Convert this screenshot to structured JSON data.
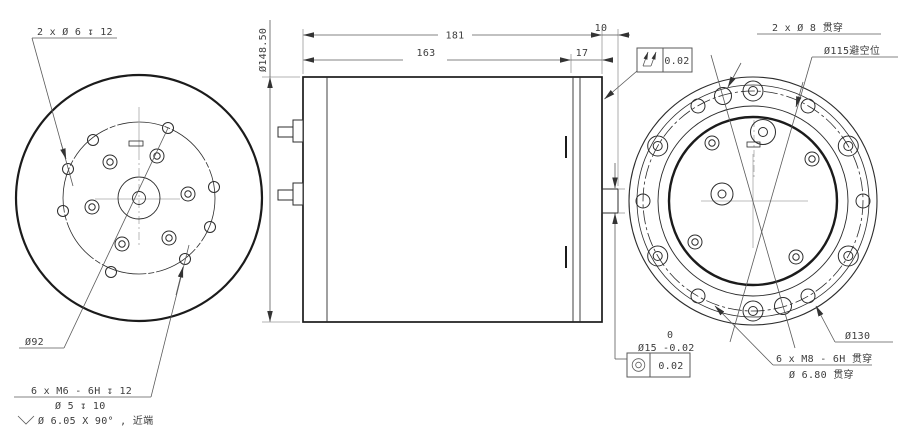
{
  "drawing": {
    "left_view": {
      "label_holes": "2 x Ø 6 ↧ 12",
      "label_bolt_circle": "Ø92",
      "label_thread1": "6 x M6 - 6H ↧ 12",
      "label_thread2": "Ø 5 ↧ 10",
      "label_thread3": "Ø 6.05 X 90° , 近端"
    },
    "front_view": {
      "dim_total": "181",
      "dim_body": "163",
      "dim_flange": "17",
      "dim_boss_len": "10",
      "dim_diameter": "Ø148.50",
      "runout_value": "0.02",
      "shaft_dia": "Ø15",
      "shaft_tol_upper": "0",
      "shaft_tol_lower": "-0.02",
      "concentricity_symbol": "◎",
      "concentricity_value": "0.02"
    },
    "right_view": {
      "label_holes": "2 x Ø 8 贯穿",
      "label_clearance": "Ø115避空位",
      "label_bolt_circle": "Ø130",
      "label_thread1": "6 x M8 - 6H 贯穿",
      "label_thread2": "Ø 6.80 贯穿"
    },
    "colors": {
      "line": "#1b1b1b",
      "dimension": "#5a5a5a",
      "background": "#ffffff"
    }
  }
}
